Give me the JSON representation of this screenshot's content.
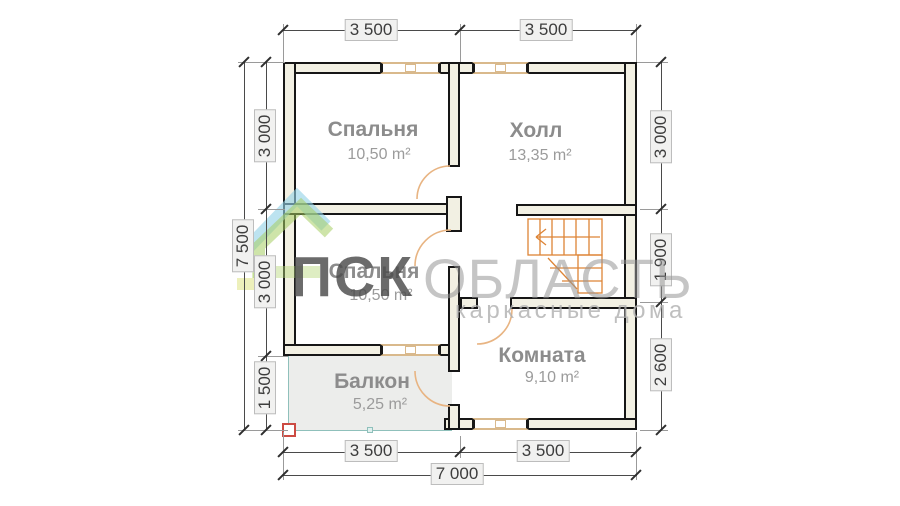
{
  "watermark": {
    "brand_bold": "ПСК",
    "brand_light": "ОБЛАСТЬ",
    "subtitle": "каркасные дома"
  },
  "rooms": {
    "bedroom1": {
      "name": "Спальня",
      "area": "10,50 m²"
    },
    "hall": {
      "name": "Холл",
      "area": "13,35 m²"
    },
    "bedroom2": {
      "name": "Спальня",
      "area": "10,50 m²"
    },
    "room": {
      "name": "Комната",
      "area": "9,10 m²"
    },
    "balcony": {
      "name": "Балкон",
      "area": "5,25 m²"
    }
  },
  "dims": {
    "top": [
      "3 500",
      "3 500"
    ],
    "left_segments": [
      "3 000",
      "3 000",
      "1 500"
    ],
    "left_total": "7 500",
    "right_segments": [
      "3 000",
      "1 900",
      "2 600"
    ],
    "bottom": [
      "3 500",
      "3 500"
    ],
    "bottom_total": "7 000"
  },
  "colors": {
    "wall_fill": "#f2f0e3",
    "wall_line": "#161616",
    "door_arc": "#e8b482",
    "stairs": "#dd8436",
    "window_frame": "#d9b98c",
    "balcony_line": "#8fc0bb",
    "balcony_fill": "#ecedeb",
    "post_red": "#cc4b43",
    "logo_blue": "#93d2e6",
    "logo_green": "#a5cd62",
    "logo_yellow": "#dde27a"
  }
}
